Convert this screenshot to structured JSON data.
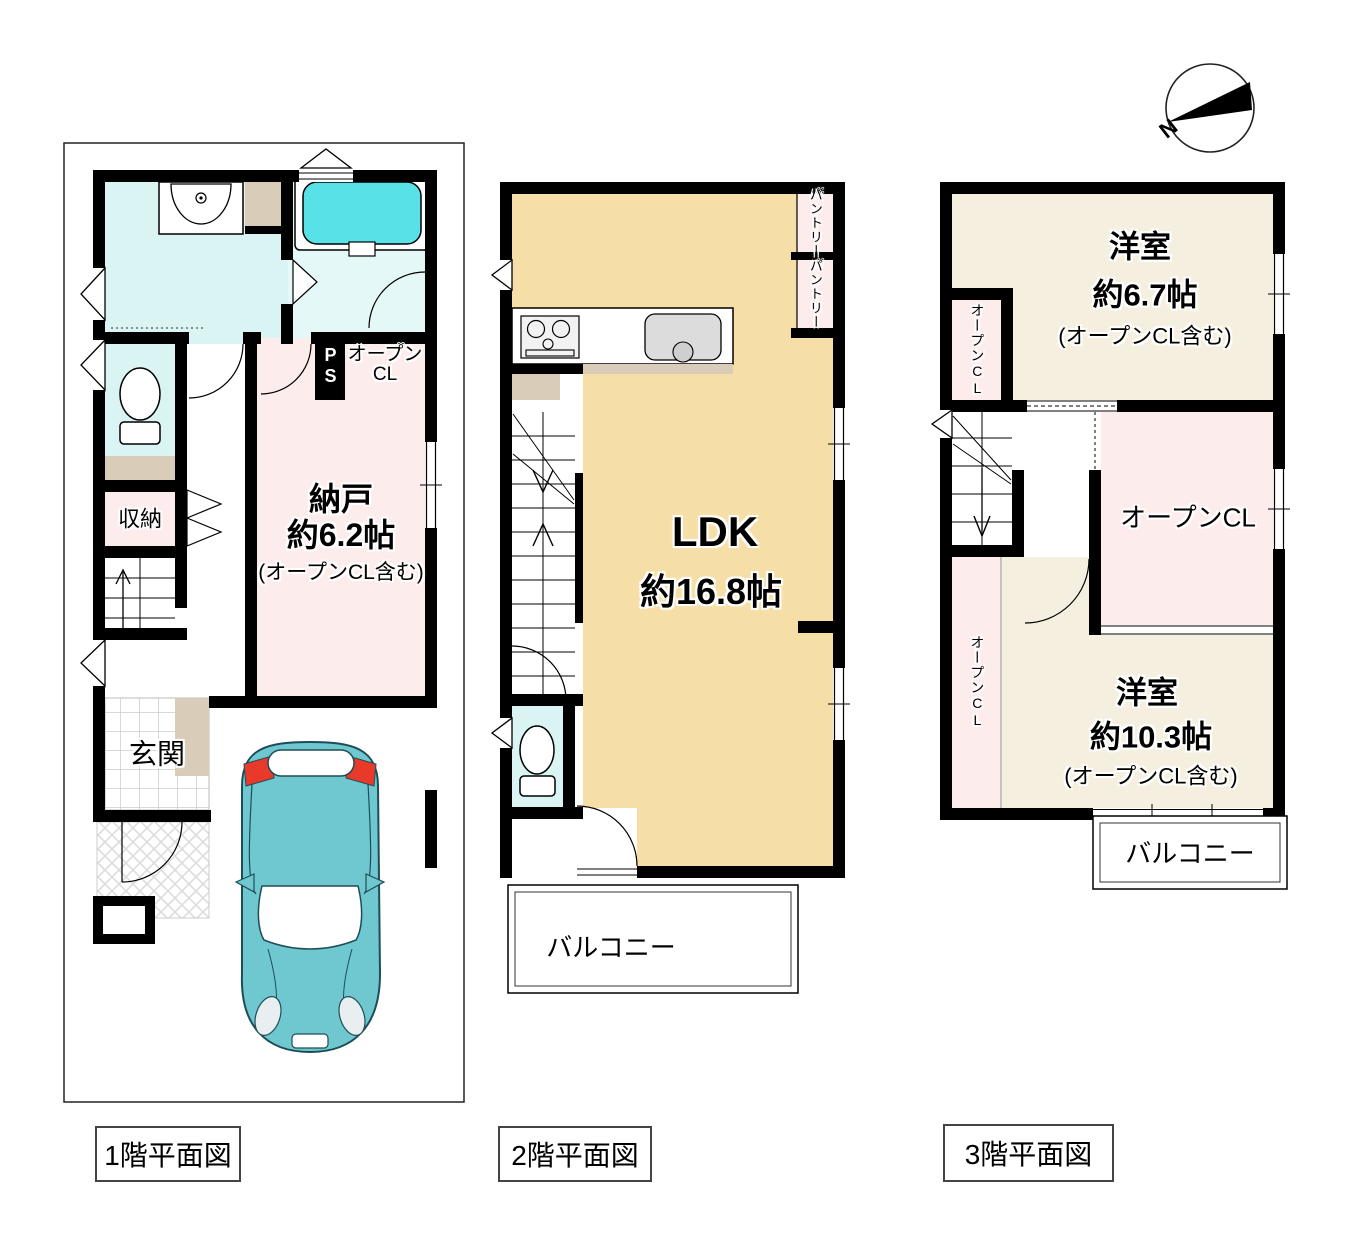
{
  "compass": {
    "north_label": "N"
  },
  "floor1": {
    "caption": "1階平面図",
    "storage_label": "収納",
    "entrance_label": "玄関",
    "ps_label": "PS",
    "open_cl_line1": "オープン",
    "open_cl_line2": "CL",
    "nando_name": "納戸",
    "nando_size": "約6.2帖",
    "nando_note": "(オープンCL含む)"
  },
  "floor2": {
    "caption": "2階平面図",
    "ldk_name": "LDK",
    "ldk_size": "約16.8帖",
    "pantry1_label": "パントリー",
    "pantry2_label": "パントリー",
    "balcony_label": "バルコニー"
  },
  "floor3": {
    "caption": "3階平面図",
    "room1_name": "洋室",
    "room1_size": "約6.7帖",
    "room1_note": "(オープンCL含む)",
    "open_cl_top_label": "オープンCL",
    "open_cl_center_label": "オープンCL",
    "open_cl_bottom_label": "オープンCL",
    "room2_name": "洋室",
    "room2_size": "約10.3帖",
    "room2_note": "(オープンCL含む)",
    "balcony_label": "バルコニー"
  }
}
